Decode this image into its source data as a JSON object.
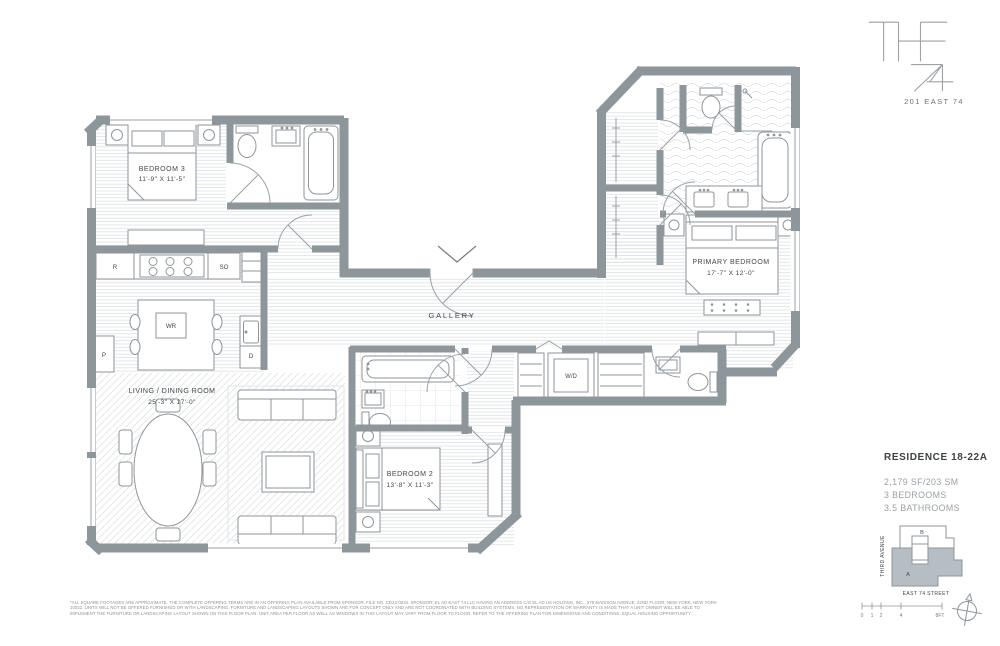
{
  "branding": {
    "name_top": "THE",
    "name_bottom": "74",
    "address": "201 EAST 74"
  },
  "residence": {
    "title": "RESIDENCE 18-22A",
    "area": "2,179 SF/203 SM",
    "bedrooms_line": "3 BEDROOMS",
    "bathrooms_line": "3.5 BATHROOMS"
  },
  "plan": {
    "rooms": {
      "bedroom3": {
        "name": "BEDROOM 3",
        "dims": "11'-9\" X 11'-5\""
      },
      "living_dining": {
        "name": "LIVING / DINING ROOM",
        "dims": "25'-3\" X 17'-0\""
      },
      "gallery": {
        "name": "GALLERY"
      },
      "bedroom2": {
        "name": "BEDROOM 2",
        "dims": "13'-8\" X 11'-3\""
      },
      "primary_bedroom": {
        "name": "PRIMARY BEDROOM",
        "dims": "17'-7\" X 12'-0\""
      }
    },
    "labels": {
      "refrigerator": "R",
      "speed_oven": "SO",
      "wine_ref": "WR",
      "pantry": "P",
      "dishwasher": "D",
      "washer_dryer": "W/D"
    }
  },
  "keymap": {
    "avenue": "THIRD AVENUE",
    "street": "EAST 74 STREET",
    "unit_a": "A",
    "unit_b": "B"
  },
  "scale_bar": {
    "ticks": [
      "0",
      "1",
      "2",
      "4",
      "8FT"
    ]
  },
  "disclaimer": {
    "line1": "*ALL SQUARE FOOTAGES ARE APPROXIMATE. THE COMPLETE OFFERING TERMS ARE IN AN OFFERING PLAN AVAILABLE FROM SPONSOR. FILE NO. CD23-0034. SPONSOR: EL AD EAST 74 LLC HAVING AN ADDRESS C/O EL AD US HOLDING, INC., 575 MADISON AVENUE, 22ND FLOOR, NEW YORK, NEW YORK",
    "line2": "10022. UNITS WILL NOT BE OFFERED FURNISHED OR WITH LANDSCAPING. FURNITURE AND LANDSCAPING LAYOUTS SHOWN ARE FOR CONCEPT ONLY AND ARE NOT COORDINATED WITH BUILDING SYSTEMS. NO REPRESENTATION OR WARRANTY IS MADE THAT A UNIT OWNER WILL BE ABLE TO",
    "line3": "IMPLEMENT THE FURNITURE OR LANDSCAPING LAYOUT SHOWN ON THIS FLOOR PLAN. UNIT AREA PER FLOOR AS WELL AS WINDOWS IN THIS LAYOUT MAY VARY FROM FLOOR TO FLOOR. REFER TO THE OFFERING PLAN FOR DIMENSIONS AND CONDITIONS. EQUAL HOUSING OPPORTUNITY."
  },
  "colors": {
    "wall": "#8d969b",
    "hatch": "#dde1e4",
    "text_dark": "#41464a",
    "text_muted": "#9aa0a4",
    "unit_a_fill": "#b7bec3"
  }
}
